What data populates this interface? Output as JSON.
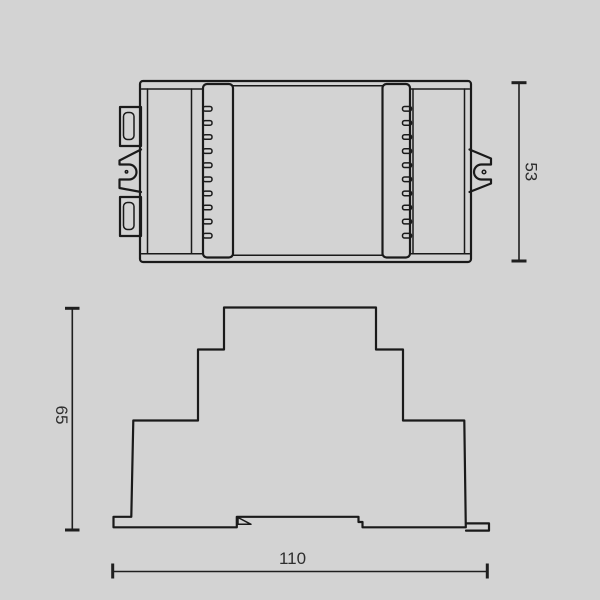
{
  "drawing": {
    "title": "din-rail-device-dimension-drawing",
    "views": {
      "top_view": "device seen from above with DIN-rail claws",
      "front_view": "stepped DIN module profile"
    },
    "dimensions": {
      "top_view_height": "53",
      "front_view_height": "65",
      "front_view_width": "110"
    },
    "colors": {
      "background": "#d3d3d3",
      "line": "#1a1a1a",
      "dimension_text": "#2e2e2e"
    }
  }
}
